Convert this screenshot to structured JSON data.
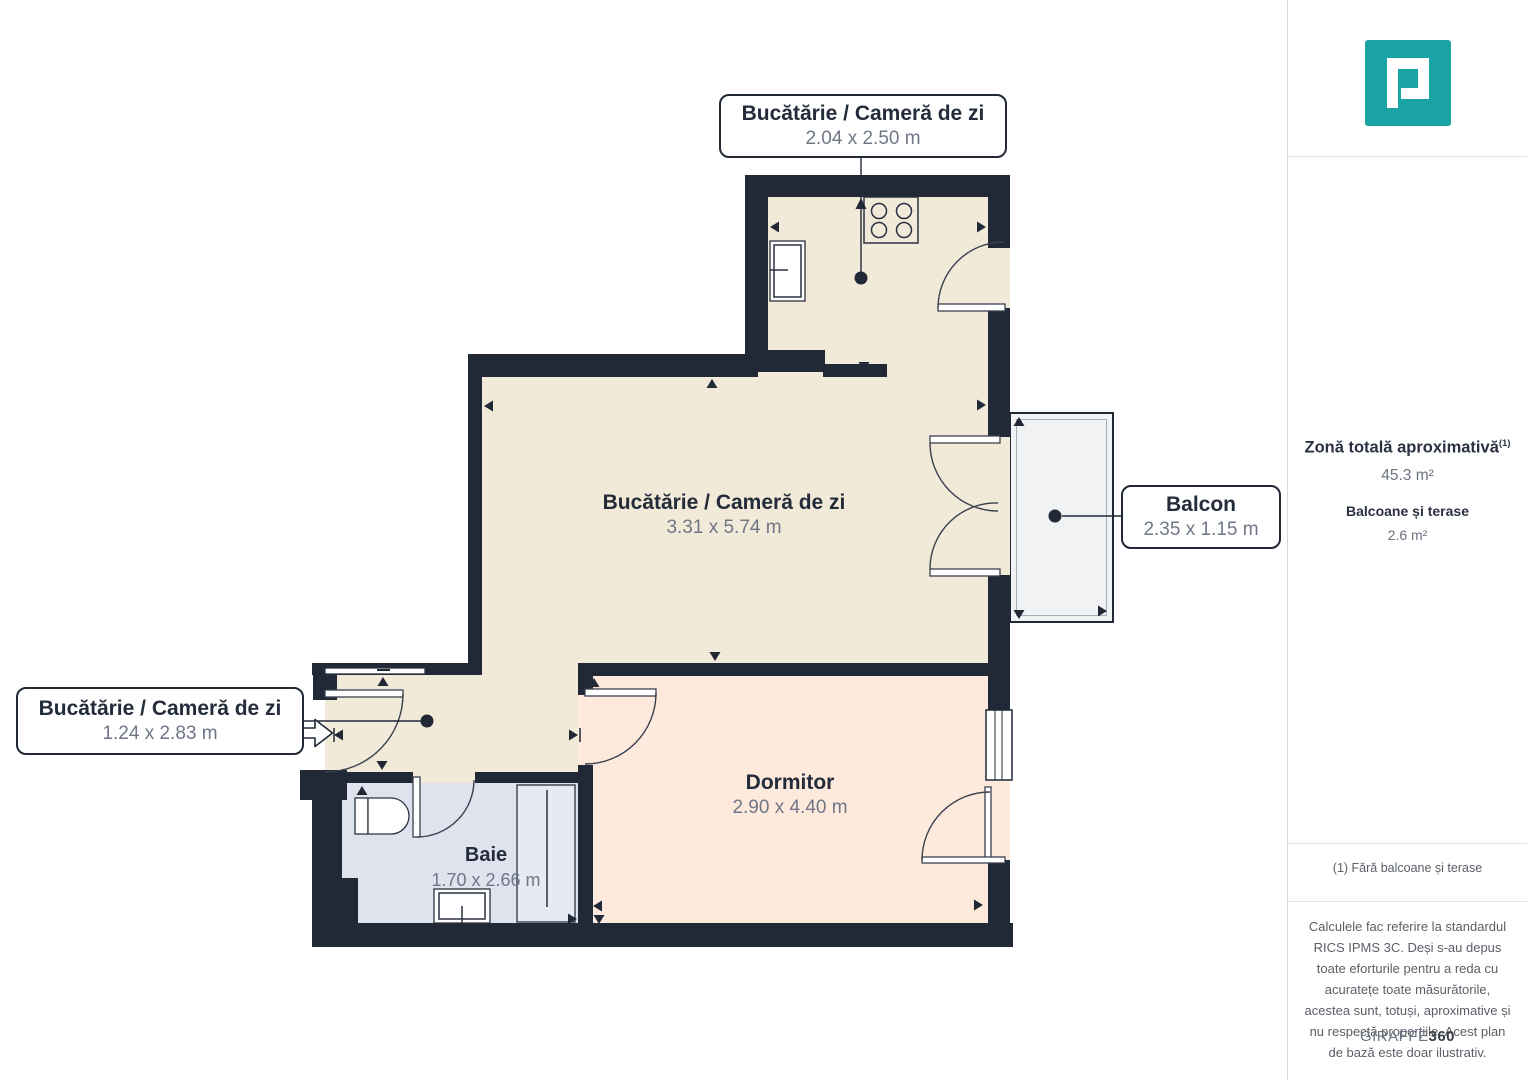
{
  "colors": {
    "wall": "#212836",
    "kitchen_floor": "#f1ead8",
    "bedroom_floor": "#fdeadc",
    "bathroom_floor": "#dfe3ee",
    "balcony_floor": "#f1f2f4",
    "logo_teal": "#19a3a4",
    "label_title": "#242c3b",
    "label_dims": "#6f7787"
  },
  "plan": {
    "fixtures": [
      "stove",
      "kitchen-sink",
      "toilet",
      "bathroom-sink",
      "shower",
      "window",
      "entry-arrow",
      "wardrobe"
    ],
    "labels": {
      "kitchen_area": {
        "title": "Bucătărie / Cameră de zi",
        "dims": "2.04 x 2.50 m"
      },
      "living": {
        "title": "Bucătărie / Cameră de zi",
        "dims": "3.31 x 5.74 m"
      },
      "hall_area": {
        "title": "Bucătărie / Cameră de zi",
        "dims": "1.24 x 2.83 m"
      },
      "balcony": {
        "title": "Balcon",
        "dims": "2.35 x 1.15 m"
      },
      "bedroom": {
        "title": "Dormitor",
        "dims": "2.90 x 4.40 m"
      },
      "bathroom": {
        "title": "Baie",
        "dims": "1.70 x 2.66 m"
      }
    }
  },
  "sidebar": {
    "total_label": "Zonă totală aproximativă",
    "total_sup": "(1)",
    "total_value": "45.3 m²",
    "balconies_label": "Balcoane și terase",
    "balconies_value": "2.6 m²",
    "footnote": "(1) Fără balcoane și terase",
    "disclaimer": "Calculele fac referire la standardul RICS IPMS 3C. Deși s-au depus toate eforturile pentru a reda cu acuratețe toate măsurătorile, acestea sunt, totuși, aproximative și nu respectă proporțiile. Acest plan de bază este doar ilustrativ.",
    "brand_name": "GIRAFFE",
    "brand_suffix": "360"
  }
}
